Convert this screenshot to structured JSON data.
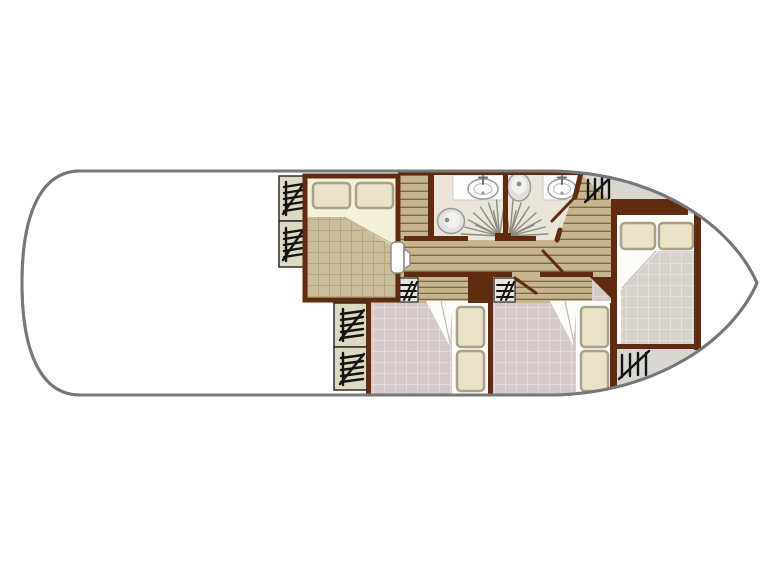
{
  "plan": {
    "type": "boat-floor-plan",
    "areas": [
      "front-deck",
      "front-double-cabin",
      "bathroom-port",
      "bathroom-starboard",
      "companionway-stairs-front",
      "corridor",
      "companionway-stairs-aft",
      "twin-cabin-port",
      "twin-cabin-starboard",
      "rear-double-cabin",
      "aft-deck"
    ],
    "furniture": {
      "double-beds": 2,
      "single-berths-per-twin-cabin": 2,
      "wardrobes": 4,
      "lockers": 2,
      "toilets": 2,
      "washbasins": 2,
      "showers": 2,
      "deck-hatches": 2
    }
  },
  "icons": [
    "wardrobe-icon",
    "locker-icon",
    "deck-hatch-icon",
    "shower-spray-icon",
    "washbasin-icon",
    "tap-icon",
    "toilet-icon",
    "door-leaf-icon"
  ],
  "colors": {
    "bg": "#ffffff",
    "hull-outline": "#75787a",
    "deck-gray": "#d9d7d2",
    "deck-edge": "#b3b1ad",
    "wall": "#5f2c12",
    "plank-base": "#c6b58f",
    "plank-line": "#7e6a46",
    "blanket-tan": "#cabd9c",
    "blanket-tan-line": "#b4a77e",
    "sheet-cream": "#f5f0da",
    "pillow-cream": "#e9e2c8",
    "pillow-edge": "#aaa189",
    "floor-pink": "#d4c9c7",
    "floor-pink-line": "#e2dad8",
    "blanket-gray": "#d5d2cb",
    "blanket-gray-line": "#e3e0db",
    "bath-floor": "#eae5d9",
    "fixture-fill": "#e3e1dd",
    "fixture-edge": "#9b9b99",
    "wardrobe-box": "#ded9c2",
    "small-box": "#e7e4de",
    "shower-line": "#8d8b84",
    "symbol": "#141414"
  }
}
